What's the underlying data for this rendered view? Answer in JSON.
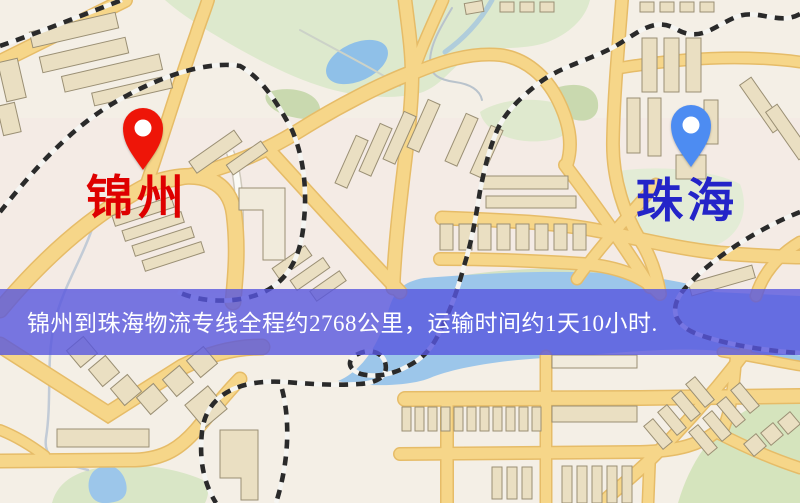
{
  "map": {
    "origin_pin": {
      "label": "锦州",
      "label_color": "#de0000",
      "pin_color": "#ee1508"
    },
    "destination_pin": {
      "label": "珠海",
      "label_color": "#2424c8",
      "pin_color": "#4d8cf2"
    },
    "banner": {
      "text": "锦州到珠海物流专线全程约2768公里，运输时间约1天10小时.",
      "text_color": "#ffffff",
      "bg_color": "rgba(88,86,222,0.80)"
    },
    "palette": {
      "land": "#f4efe6",
      "road_fill": "#f6d689",
      "road_edge": "#e6bc68",
      "water": "#9cc6ea",
      "park": "#dde9cd",
      "park_dark": "#c9d9af",
      "building": "#eadfc2",
      "railway": "#2a2a2a"
    }
  }
}
